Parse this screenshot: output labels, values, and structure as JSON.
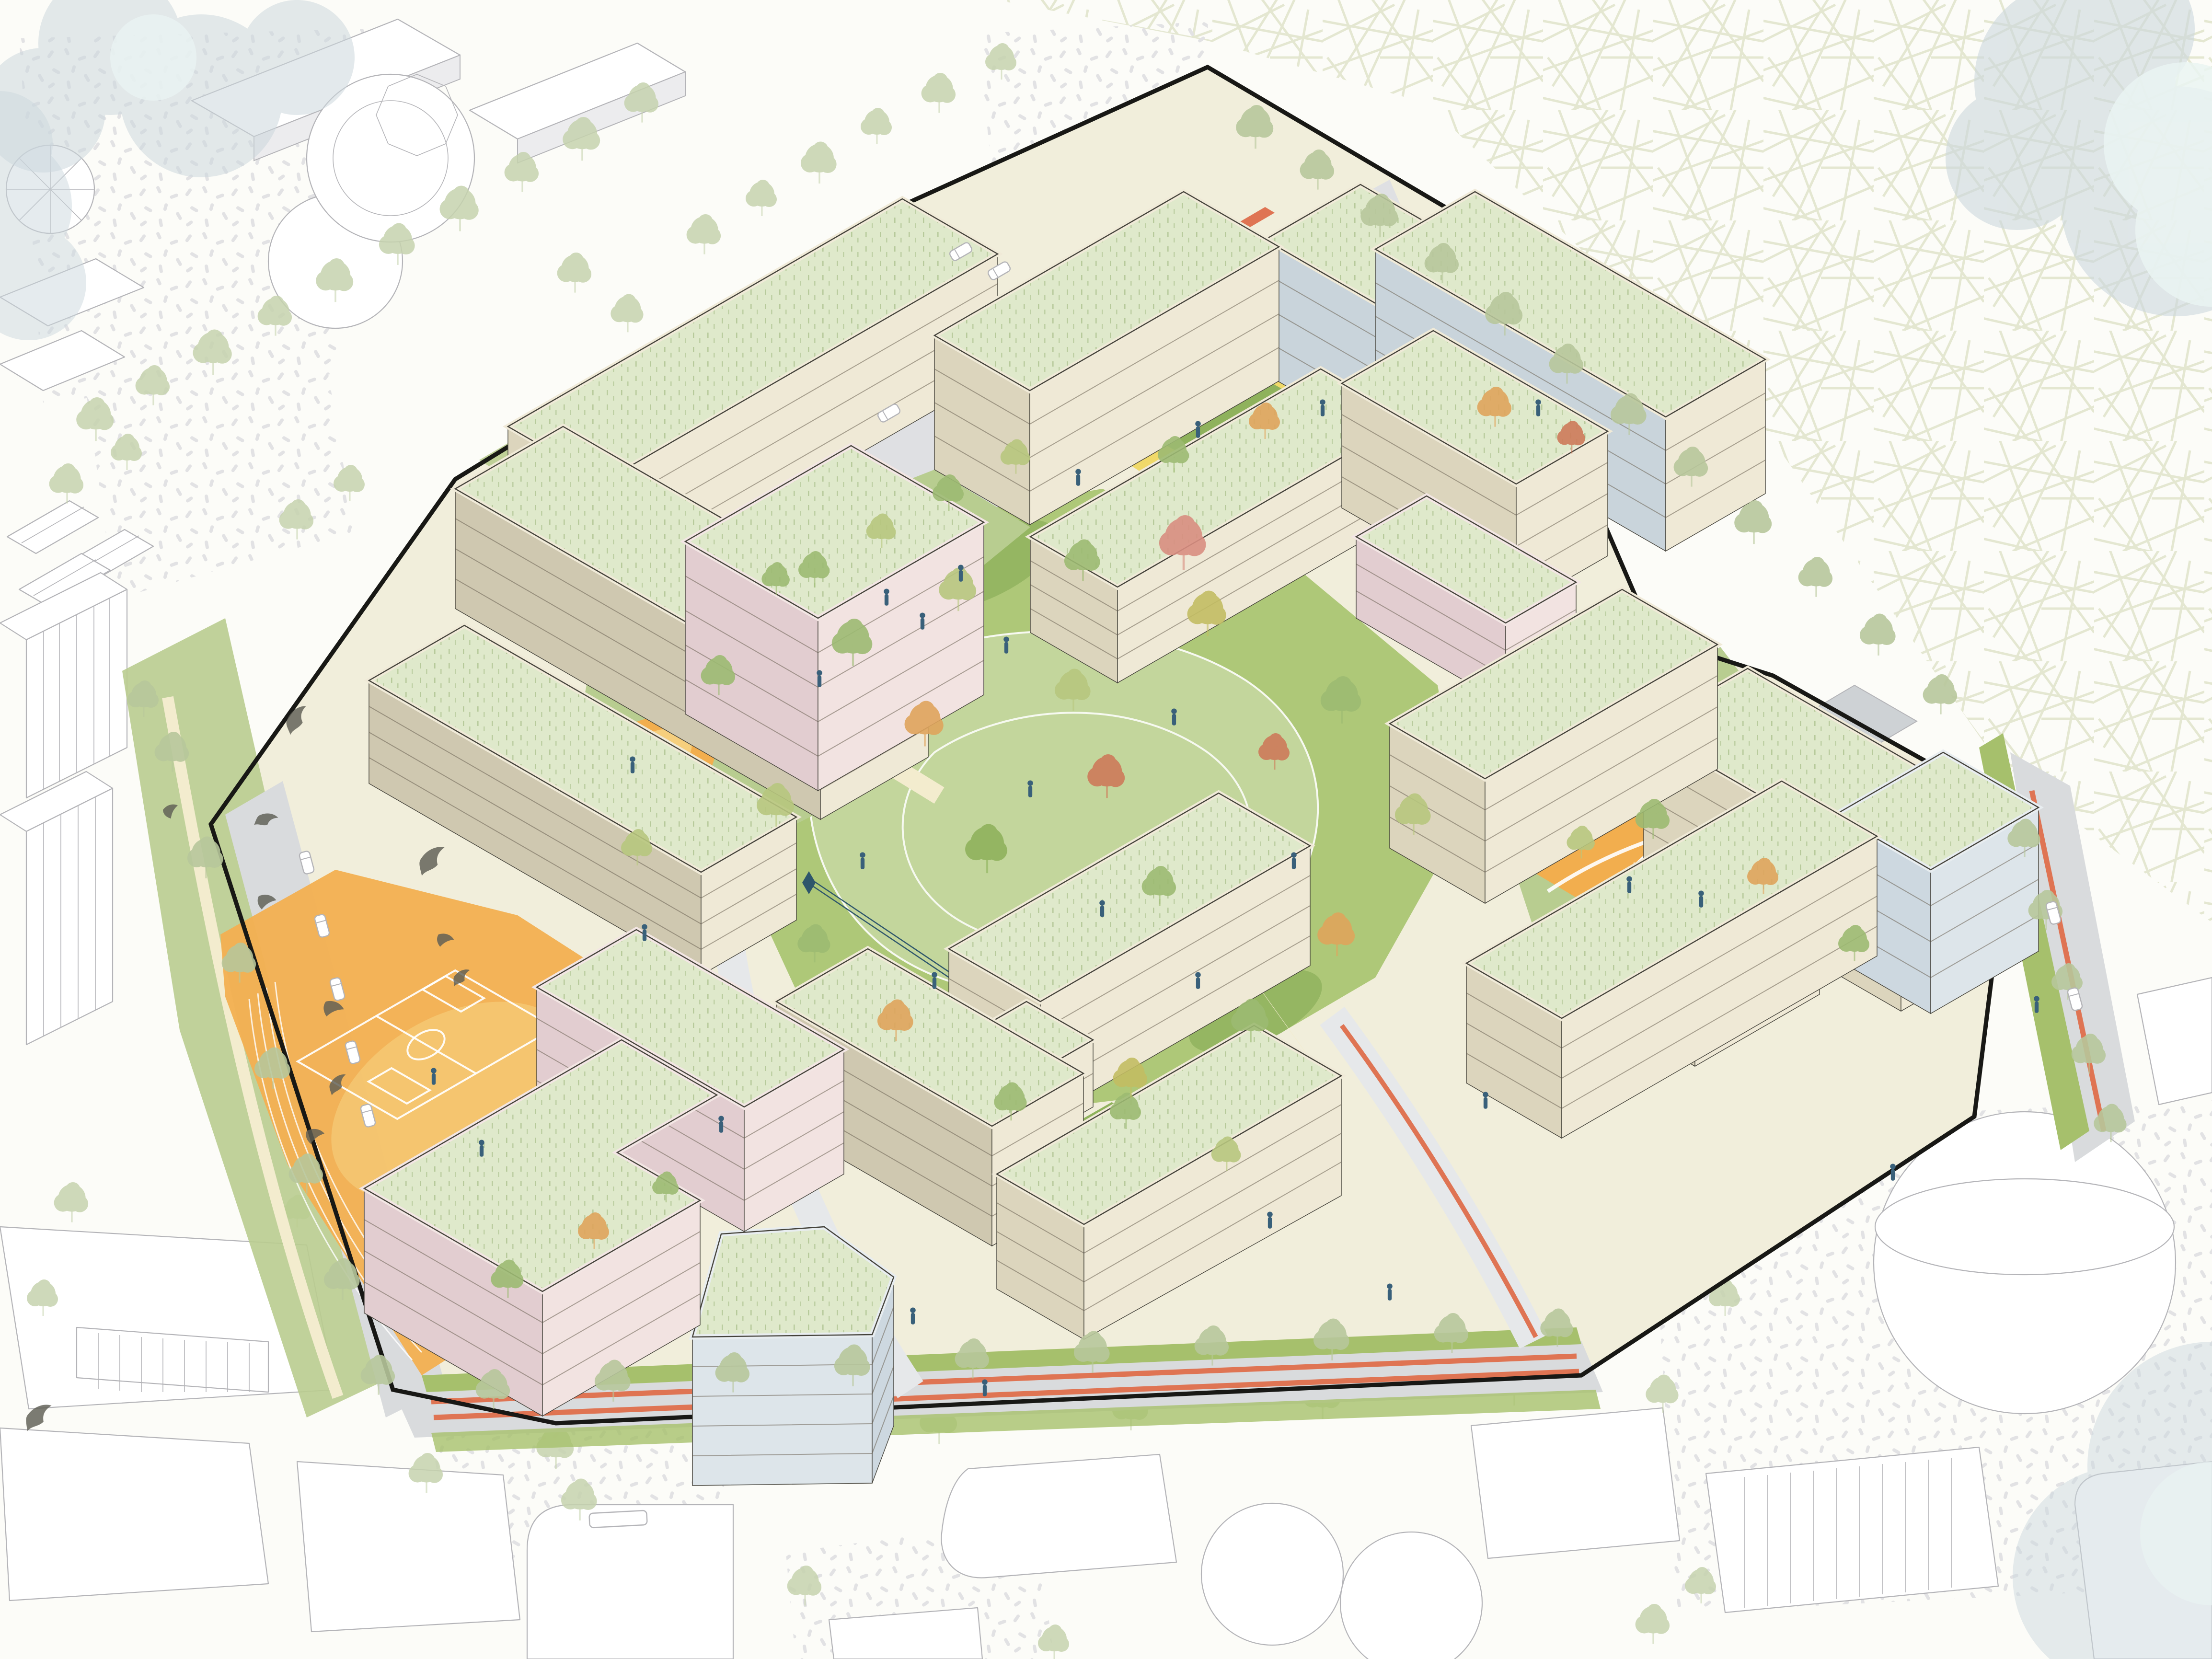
{
  "meta": {
    "title": "Residential masterplan - axonometric site illustration",
    "type": "architectural axonometric drawing",
    "projection": "isometric 30-degree",
    "visible_text": "none"
  },
  "colors": {
    "bg": "#fcfcf8",
    "hatch_line": "#e1e5cd",
    "stipple_dot": "#e2e2e4",
    "cloud": "#ccd7dd",
    "cloud_light": "#eaf4f2",
    "ctx_line": "#b4b4b8",
    "ctx_side": "#ececee",
    "site_base": "#f1eedb",
    "park": "#aec878",
    "park_light": "#c6d8a1",
    "lawn": "#b8cd90",
    "lawn_dark": "#8fb25c",
    "slope_green": "#b9cc8f",
    "verge_green": "#a6c06c",
    "street_gray": "#d9dbdd",
    "plaza_gray": "#dfe0e3",
    "gray_court": "#ced2d5",
    "path_cream": "#f3ecce",
    "court_yellow": "#f0d75f",
    "court_orange": "#f5b64f",
    "play_orange": "#f2ae4e",
    "play_peach": "#f6d383",
    "field_orange": "#f3b052",
    "bike_red": "#df7453",
    "roof_green": "#dfe9cb",
    "roof_dash": "#a9c08b",
    "parapet": "#f0ead8",
    "parapet_pink": "#f3e6e4",
    "parapet_blue": "#e8edf0",
    "facade_front": "#efe9d6",
    "facade_side": "#dcd5bd",
    "facade_taupe": "#cfc8b0",
    "facade_pink_front": "#f2e3e1",
    "facade_pink_side": "#e2cdd0",
    "glass_wall": "#c9d4db",
    "glass_blue": "#dde5ea",
    "glass_blue_side": "#cdd8e0",
    "floor_line": "#6b6354",
    "ink": "#44423a",
    "boundary": "#181815",
    "person": "#39607a",
    "bird": "#5f5e55",
    "ramp_green": "#a8c075",
    "pitch_line": "#ffffff",
    "orange_ring": "#eaa53e",
    "zip": "#2e566b",
    "tree_ctx": "#c6d3ae",
    "tree_ctx2": "#a8bd8a",
    "tree_green": "#9cba72",
    "tree_light": "#b7c77e",
    "tree_olive": "#c2bd62",
    "tree_orange": "#dfa45c",
    "tree_red": "#cd7a5a",
    "tree_rose": "#d98e80"
  },
  "scene": {
    "background": [
      "white paper",
      "cross-hatch woodland texture upper right",
      "gray stipple ground patches",
      "translucent blue-gray tree-canopy clouds in corners"
    ],
    "context": [
      "white line-drawn neighbourhood buildings on left, bottom and right",
      "cylindrical tower top-left",
      "round pavilion",
      "gabled houses",
      "twin silos bottom-center",
      "large cylinder bottom-right"
    ],
    "site": {
      "boundary": "thick black polygon around development site",
      "landscape": [
        "central park with mown-contour lawns and autumn trees",
        "orange sports field with soccer pitch and running track",
        "NW gray plaza with green planted ramp stripes",
        "zip-line in park",
        "three orange playgrounds with white climbing frames",
        "street grid with salmon-red cycle lanes",
        "green verges with street trees"
      ],
      "buildings": [
        {
          "name": "block-A-north-bar",
          "palette": "cream",
          "roof": "extensive green roof"
        },
        {
          "name": "block-A-west-bar",
          "palette": "cream/taupe",
          "roof": "green"
        },
        {
          "name": "block-A-low-bar",
          "palette": "cream",
          "roof": "green"
        },
        {
          "name": "block-A-pink-tower",
          "palette": "pink",
          "roof": "green"
        },
        {
          "name": "block-B-north-bar",
          "palette": "cream",
          "roof": "green"
        },
        {
          "name": "block-B-east-bar",
          "palette": "glass courtyard wall",
          "roof": "green"
        },
        {
          "name": "block-B-south-low-bar",
          "palette": "cream",
          "roof": "green"
        },
        {
          "name": "block-C-ne-bar",
          "palette": "cream with glass courtyard wall",
          "roof": "green"
        },
        {
          "name": "block-C-west-bar",
          "palette": "cream",
          "roof": "green"
        },
        {
          "name": "block-C-pink-wing",
          "palette": "pink",
          "roof": "green"
        },
        {
          "name": "block-D-ne-bar",
          "palette": "cream",
          "roof": "green"
        },
        {
          "name": "block-D-nw-bar",
          "palette": "cream",
          "roof": "green"
        },
        {
          "name": "block-D-court-bar",
          "palette": "cream",
          "roof": "green"
        },
        {
          "name": "block-D-blue-block",
          "palette": "blue glass",
          "roof": "green"
        },
        {
          "name": "block-D-south-bar",
          "palette": "cream",
          "roof": "green"
        },
        {
          "name": "block-E-upper-bar",
          "palette": "cream",
          "roof": "green"
        },
        {
          "name": "block-E-low-link",
          "palette": "cream",
          "roof": "green"
        },
        {
          "name": "block-E-west-bar",
          "palette": "cream",
          "roof": "green"
        },
        {
          "name": "block-E-south-bar",
          "palette": "cream",
          "roof": "green"
        },
        {
          "name": "block-E-blue-pentagon",
          "palette": "blue",
          "roof": "green"
        },
        {
          "name": "block-F-north-pink-bar",
          "palette": "pink",
          "roof": "green"
        },
        {
          "name": "block-F-south-pink-z",
          "palette": "pink",
          "roof": "green"
        }
      ]
    },
    "figures": {
      "people": 30,
      "birds": 11,
      "parked_cars": 10,
      "bus": 1
    }
  }
}
